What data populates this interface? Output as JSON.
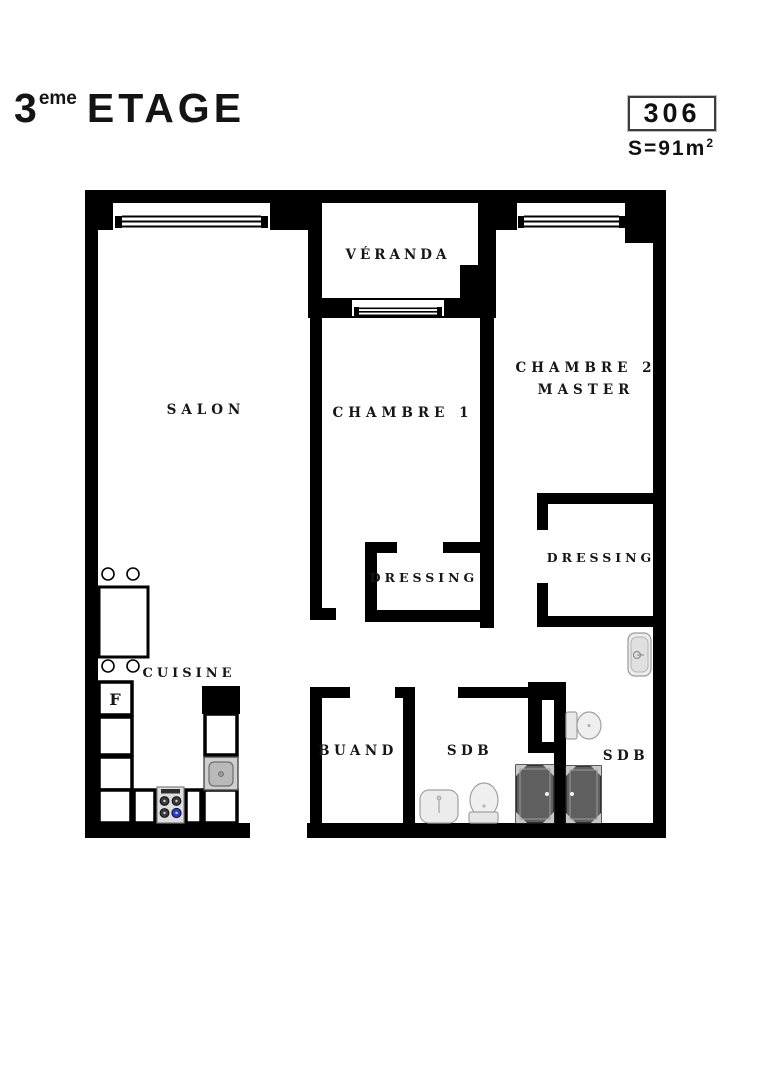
{
  "header": {
    "floor_number": "3",
    "floor_ordinal_suffix": "eme",
    "floor_label": "ETAGE",
    "unit_number": "306",
    "surface_label": "S=91",
    "surface_unit": "m",
    "surface_exponent": "2"
  },
  "plan": {
    "rooms": {
      "veranda": {
        "label": "VÉRANDA"
      },
      "salon": {
        "label": "SALON"
      },
      "chambre1": {
        "label": "CHAMBRE 1"
      },
      "chambre2": {
        "label_line1": "CHAMBRE 2",
        "label_line2": "MASTER"
      },
      "dressing_chambre1": {
        "label": "DRESSING"
      },
      "dressing_master": {
        "label": "DRESSING"
      },
      "cuisine": {
        "label": "CUISINE"
      },
      "buanderie": {
        "label": "BUAND"
      },
      "sdb_1": {
        "label": "SDB"
      },
      "sdb_master": {
        "label": "SDB"
      },
      "fridge": {
        "label": "F"
      }
    },
    "fixtures": [
      "window",
      "table",
      "stool",
      "fridge",
      "kitchen-sink",
      "hob",
      "washbasin",
      "toilet",
      "shower",
      "duct-shaft"
    ],
    "colors": {
      "wall": "#000000",
      "fixture_light": "#ececec",
      "fixture_mid": "#c9c9c9",
      "shower_dark": "#5f5f5f",
      "burner_blue": "#2a3bd6"
    }
  }
}
